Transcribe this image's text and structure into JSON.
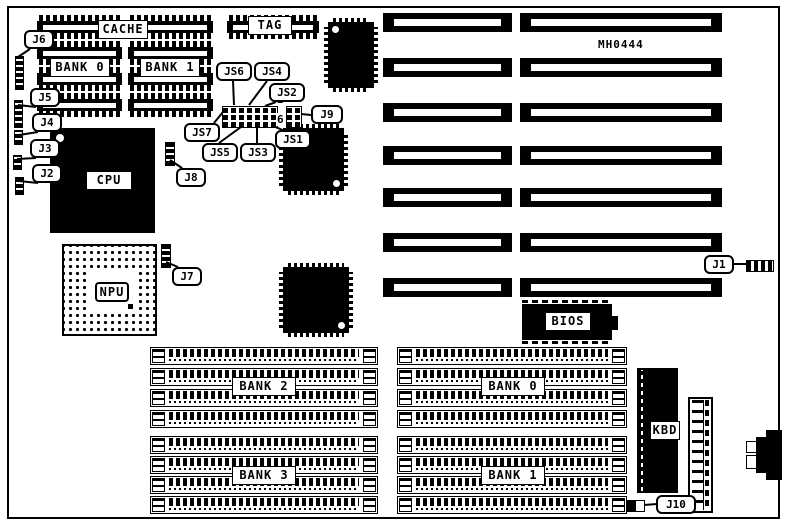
{
  "board": {
    "part_number": "MH0444"
  },
  "chips": {
    "cache": "CACHE",
    "cache_bank0": "BANK 0",
    "cache_bank1": "BANK 1",
    "tag": "TAG",
    "cpu": "CPU",
    "npu": "NPU",
    "bios": "BIOS",
    "kbd": "KBD"
  },
  "memory_banks": {
    "bank2": "BANK 2",
    "bank3": "BANK 3",
    "bank0": "BANK 0",
    "bank1": "BANK 1"
  },
  "jumpers": {
    "j1": "J1",
    "j2": "J2",
    "j3": "J3",
    "j4": "J4",
    "j5": "J5",
    "j6": "J6",
    "j7": "J7",
    "j8": "J8",
    "j9": "J9",
    "j10": "J10"
  },
  "switch_jumpers": {
    "js1": "JS1",
    "js2": "JS2",
    "js3": "JS3",
    "js4": "JS4",
    "js5": "JS5",
    "js6": "JS6",
    "js7": "JS7"
  },
  "j9_pin_labels": {
    "top": "2",
    "bottom": "6"
  },
  "counts": {
    "isa_slots": 7,
    "simm_sockets_per_bank": 4,
    "memory_bank_groups": 4,
    "cache_chips_per_bank": 4
  },
  "colors": {
    "ink": "#000000",
    "paper": "#ffffff"
  }
}
